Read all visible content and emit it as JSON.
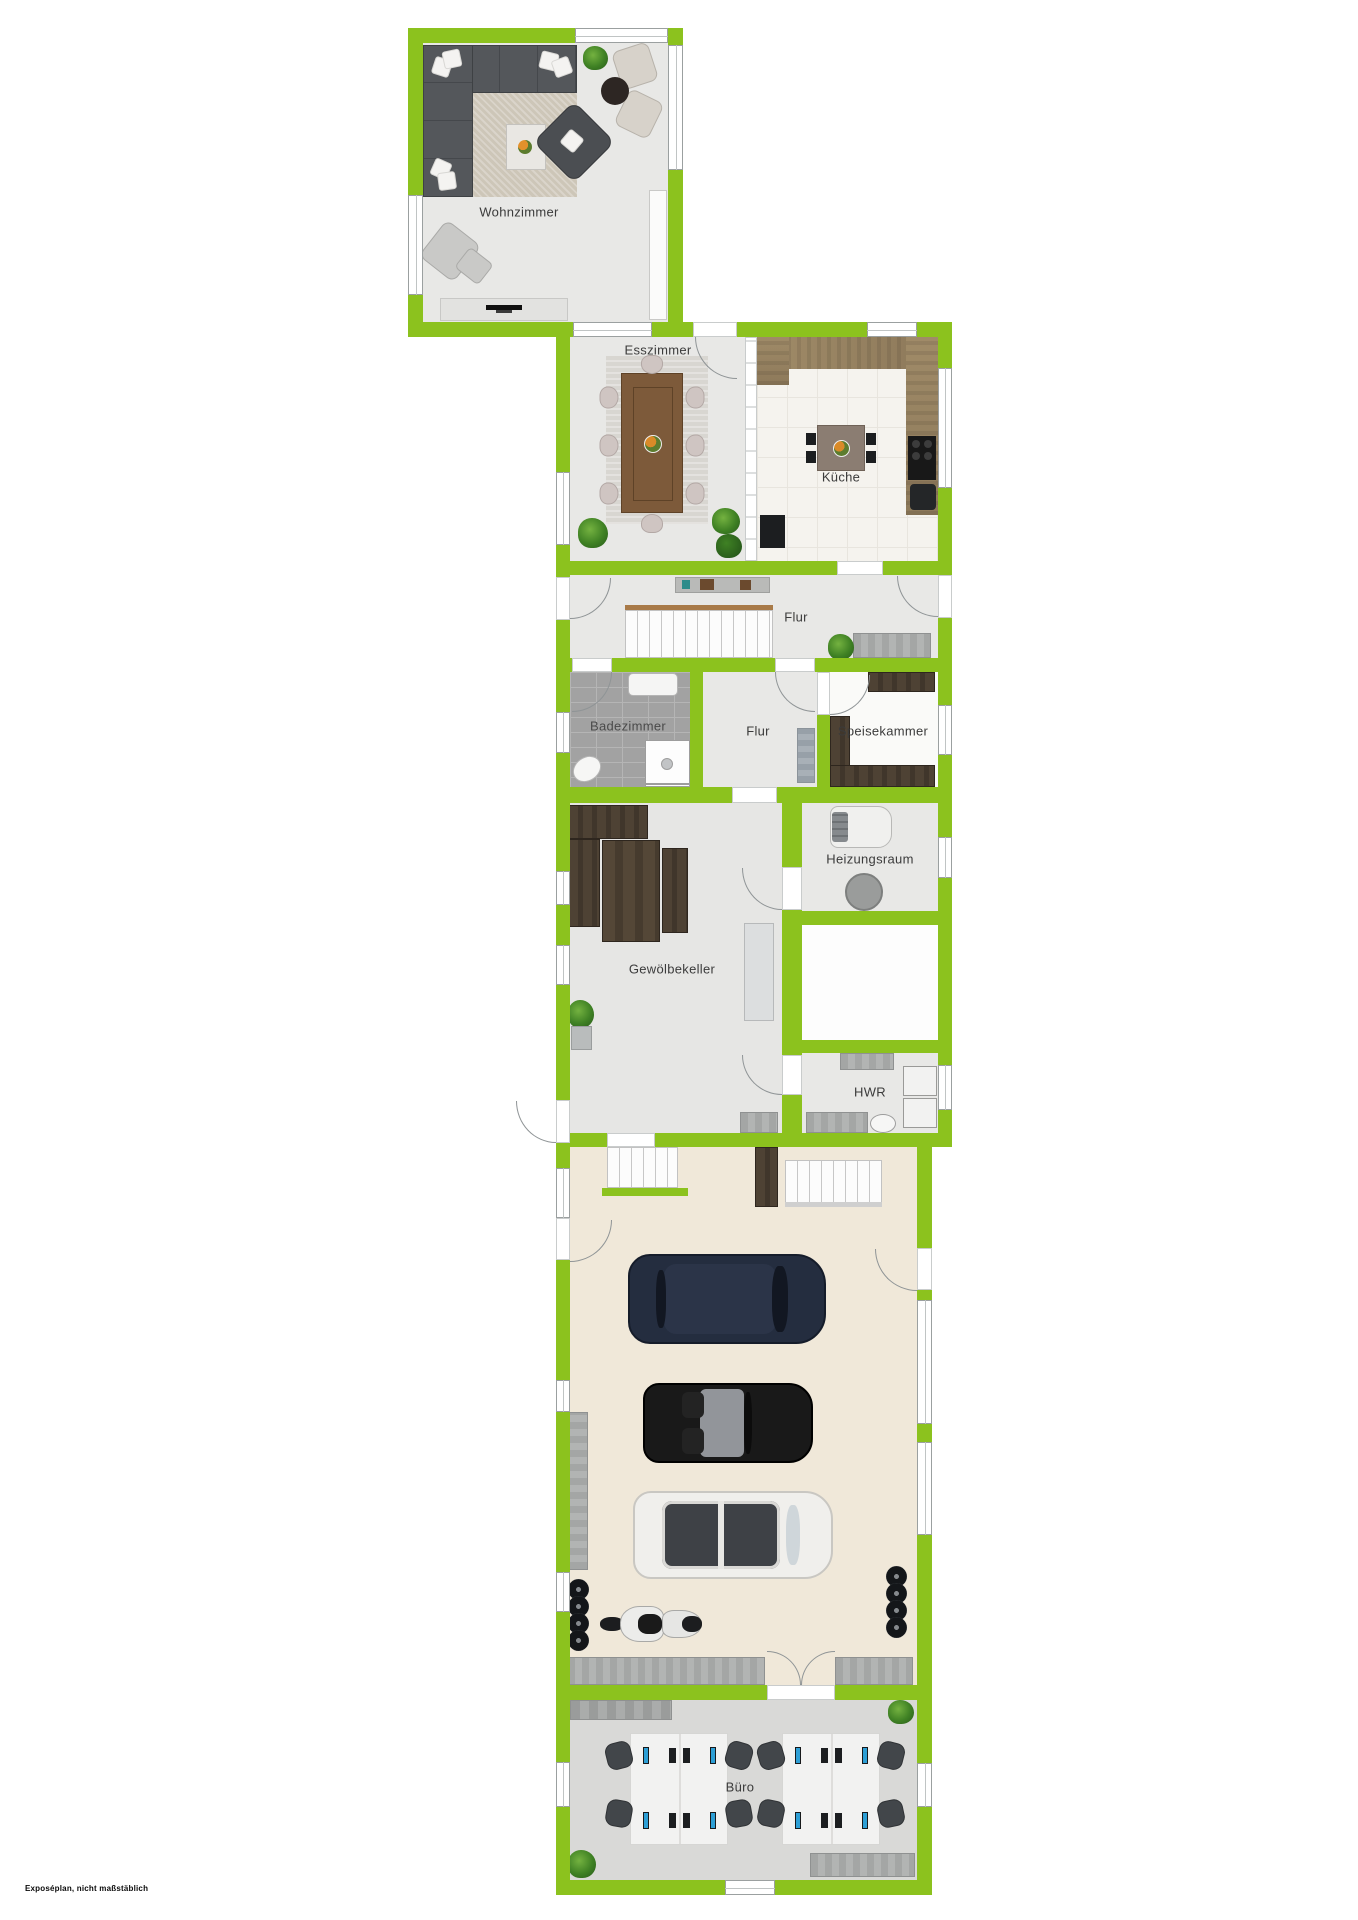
{
  "footer": {
    "note": "Exposéplan, nicht maßstäblich"
  },
  "colors": {
    "wall_green": "#8cc21e",
    "floor_light_gray": "#e8e8e6",
    "floor_office": "#d9d9d7",
    "floor_garage": "#f0e8d9",
    "kitchen_tile": "#f5f3ee",
    "bath_tile": "#a2a2a2",
    "counter_wood": "#97825f",
    "rustic_wood": "#4c4134"
  },
  "rooms": {
    "wohnzimmer": {
      "label": "Wohnzimmer"
    },
    "esszimmer": {
      "label": "Esszimmer"
    },
    "kueche": {
      "label": "Küche"
    },
    "flur_og": {
      "label": "Flur"
    },
    "badezimmer": {
      "label": "Badezimmer"
    },
    "flur_ug": {
      "label": "Flur"
    },
    "speisekammer": {
      "label": "Speisekammer"
    },
    "heizungsraum": {
      "label": "Heizungsraum"
    },
    "gewoelbekeller": {
      "label": "Gewölbekeller"
    },
    "hwr": {
      "label": "HWR"
    },
    "buero": {
      "label": "Büro"
    }
  }
}
